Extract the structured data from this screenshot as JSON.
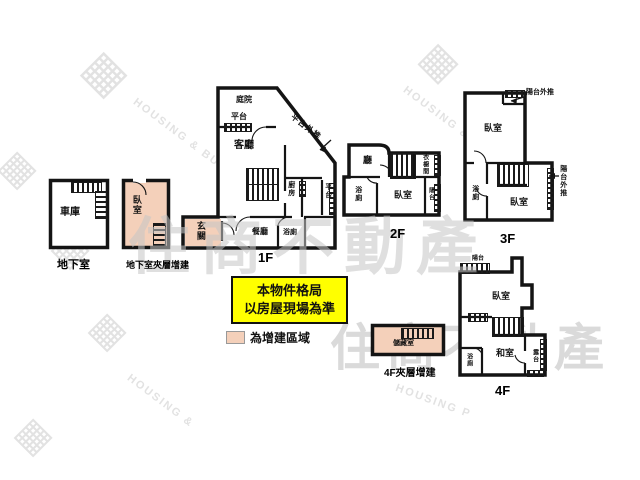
{
  "watermark": {
    "brand": "住商不動產",
    "brand_en": "HOUSING & BUSINESS",
    "brand_en_frag_left": "HOUSING &",
    "brand_en_frag_right": "HOUSING P",
    "logo_glyph": "▦"
  },
  "note": {
    "line1": "本物件格局",
    "line2": "以房屋現場為準"
  },
  "legend": {
    "label": "為增建區域"
  },
  "colors": {
    "addition_fill": "#f4d0ba",
    "note_bg": "#ffff00",
    "wall": "#141414"
  },
  "floors": {
    "basement": {
      "name": "地下室",
      "garage": "車庫"
    },
    "basement_mezz": {
      "name": "地下室夾層增建",
      "bedroom": "臥室"
    },
    "f1": {
      "name": "1F",
      "yard": "庭院",
      "platform_top": "平台",
      "living": "客廳",
      "kitchen": "廚房",
      "dining": "餐廳",
      "bath": "浴廁",
      "platform_right": "平台",
      "entry": "玄關",
      "platform_ext": "平台外推"
    },
    "f2": {
      "name": "2F",
      "hall": "廳",
      "bath": "浴廁",
      "bedroom": "臥室",
      "closet": "衣櫥間",
      "balcony": "陽台"
    },
    "f3": {
      "name": "3F",
      "bedroom_top": "臥室",
      "bedroom_bottom": "臥室",
      "bath": "浴廁",
      "balcony_ext_top": "陽台外推",
      "balcony_ext_right": "陽台外推"
    },
    "f4": {
      "name": "4F",
      "balcony": "陽台",
      "bedroom": "臥室",
      "tatami": "和室",
      "bath": "浴廁",
      "terrace": "露台"
    },
    "f4_mezz": {
      "name": "4F夾層增建",
      "storage": "儲藏室"
    }
  }
}
